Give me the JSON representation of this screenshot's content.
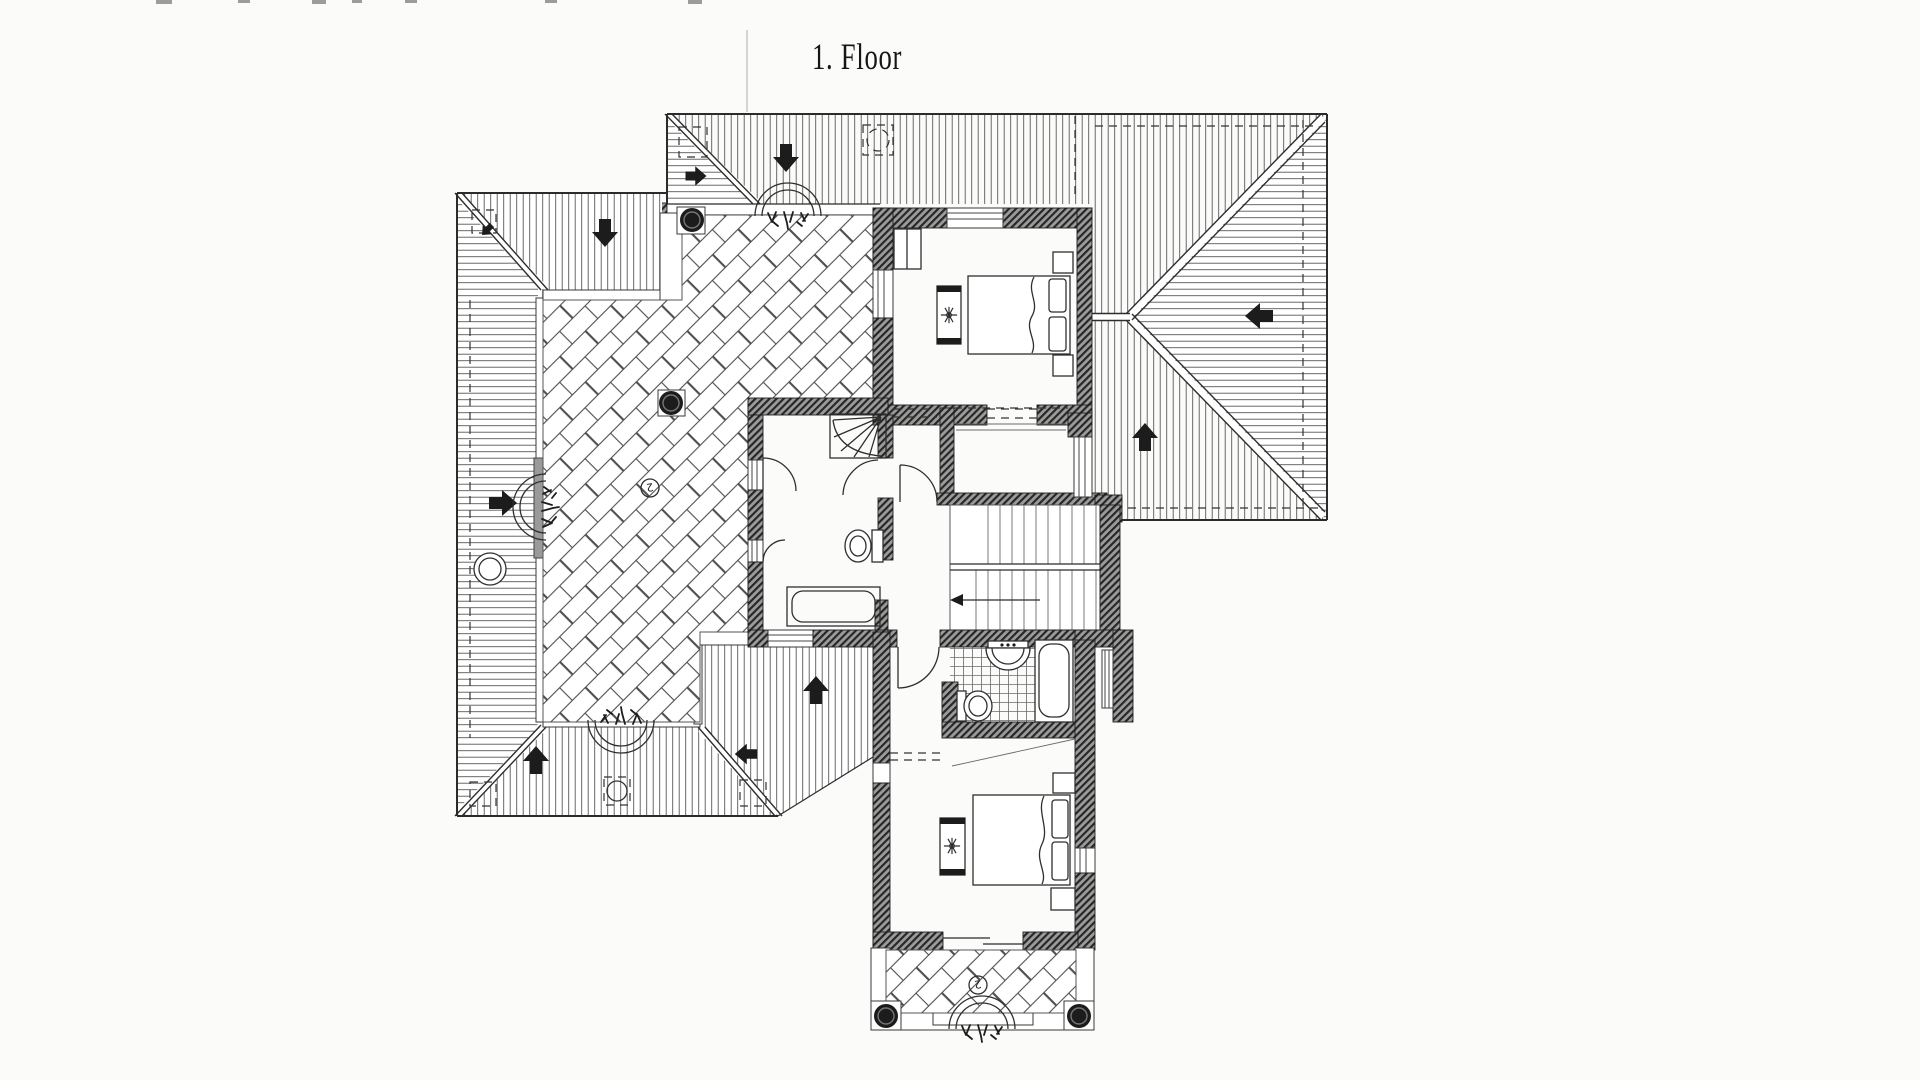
{
  "title": {
    "text": "1. Floor"
  },
  "annotations": {
    "terrace_mark": "2",
    "balcony_mark": "2"
  },
  "colors": {
    "paper": "#fbfbfa",
    "ink": "#2b2b2b",
    "hatch": "#585858",
    "wall": "#9b9b9b",
    "dark": "#1c1c1c"
  }
}
